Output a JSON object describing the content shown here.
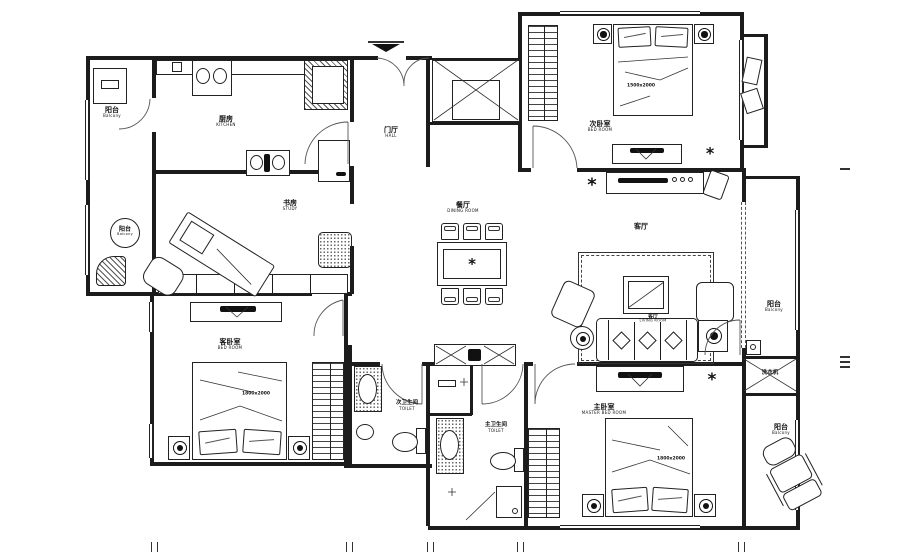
{
  "rooms": {
    "balcony_nw": {
      "zh": "阳台",
      "en": "Balcony"
    },
    "balcony_w": {
      "zh": "阳台",
      "en": "Balcony"
    },
    "kitchen": {
      "zh": "厨房",
      "en": "KITCHEN"
    },
    "hall": {
      "zh": "门厅",
      "en": "HALL"
    },
    "study": {
      "zh": "书房",
      "en": "STUDY"
    },
    "dining": {
      "zh": "餐厅",
      "en": "DINING ROOM"
    },
    "bedroom_second": {
      "zh": "次卧室",
      "en": "BED ROOM"
    },
    "living_tag": "客厅",
    "living": {
      "zh": "客厅",
      "en": "LIVING ROOM"
    },
    "balcony_east": {
      "zh": "阳台",
      "en": "Balcony"
    },
    "laundry_cabinet": "洗衣机",
    "bedroom_guest": {
      "zh": "客卧室",
      "en": "BED ROOM"
    },
    "bath_second": {
      "zh": "次卫生间",
      "en": "TOILET"
    },
    "bath_master": {
      "zh": "主卫生间",
      "en": "TOILET"
    },
    "bedroom_master": {
      "zh": "主卧室",
      "en": "MASTER BED ROOM"
    },
    "balcony_se": {
      "zh": "阳台",
      "en": "Balcony"
    }
  },
  "annotations": {
    "bed_second_size": "1500x2000",
    "bed_guest_size": "1800x2000",
    "bed_master_size": "1800x2000"
  },
  "icons": {
    "plant_glyph": "*",
    "star_glyph": "*"
  },
  "colors": {
    "line": "#1c1c1c",
    "background": "#ffffff"
  }
}
